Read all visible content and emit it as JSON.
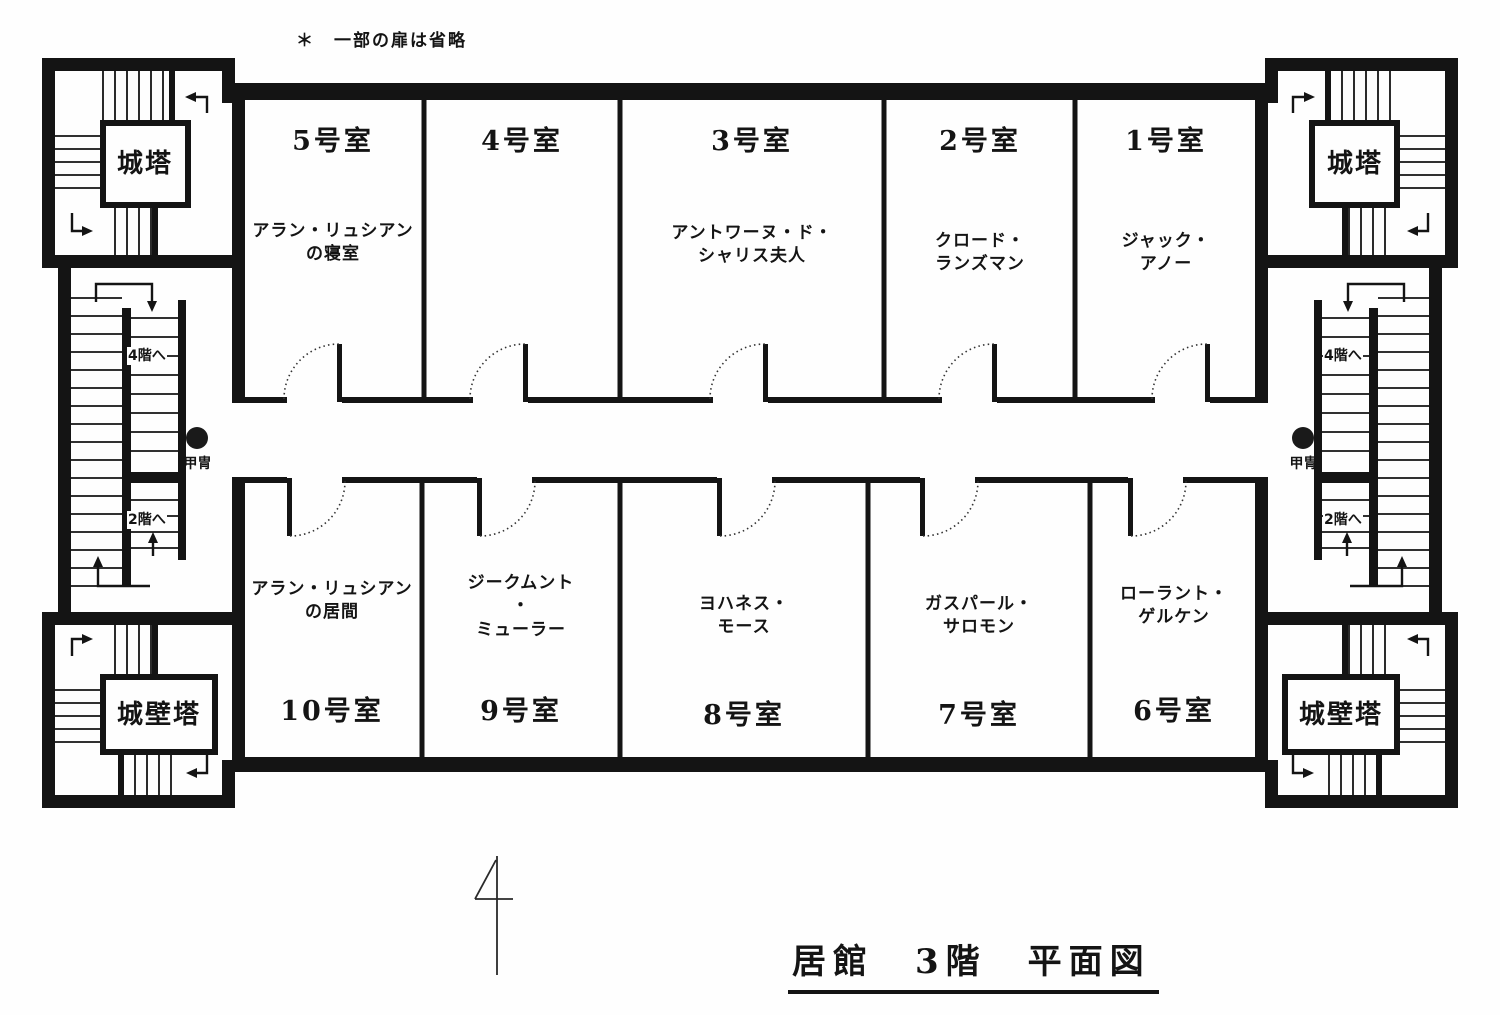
{
  "note": "＊　一部の扉は省略",
  "title": "居館　3階　平面図",
  "marginal_mark": "4",
  "labels": {
    "to_4f": "4階へ",
    "to_2f": "2階へ",
    "armor": "甲冑"
  },
  "towers": {
    "top_left": "城塔",
    "top_right": "城塔",
    "bottom_left": "城壁塔",
    "bottom_right": "城壁塔"
  },
  "rooms": [
    {
      "number": "5号室",
      "occupant": "アラン・リュシアンの寝室",
      "occupant_lines": [
        "アラン・リュシアン",
        "の寝室"
      ]
    },
    {
      "number": "4号室",
      "occupant": "",
      "occupant_lines": []
    },
    {
      "number": "3号室",
      "occupant": "アントワーヌ・ド・シャリス夫人",
      "occupant_lines": [
        "アントワーヌ・ド・",
        "シャリス夫人"
      ]
    },
    {
      "number": "2号室",
      "occupant": "クロード・ランズマン",
      "occupant_lines": [
        "クロード・",
        "ランズマン"
      ]
    },
    {
      "number": "1号室",
      "occupant": "ジャック・アノー",
      "occupant_lines": [
        "ジャック・",
        "アノー"
      ]
    },
    {
      "number": "10号室",
      "occupant": "アラン・リュシアンの居間",
      "occupant_lines": [
        "アラン・リュシアン",
        "の居間"
      ]
    },
    {
      "number": "9号室",
      "occupant": "ジークムント・ミューラー",
      "occupant_lines": [
        "ジークムント",
        "・",
        "ミューラー"
      ]
    },
    {
      "number": "8号室",
      "occupant": "ヨハネス・モース",
      "occupant_lines": [
        "ヨハネス・",
        "モース"
      ]
    },
    {
      "number": "7号室",
      "occupant": "ガスパール・サロモン",
      "occupant_lines": [
        "ガスパール・",
        "サロモン"
      ]
    },
    {
      "number": "6号室",
      "occupant": "ローラント・ゲルケン",
      "occupant_lines": [
        "ローラント・",
        "ゲルケン"
      ]
    }
  ]
}
